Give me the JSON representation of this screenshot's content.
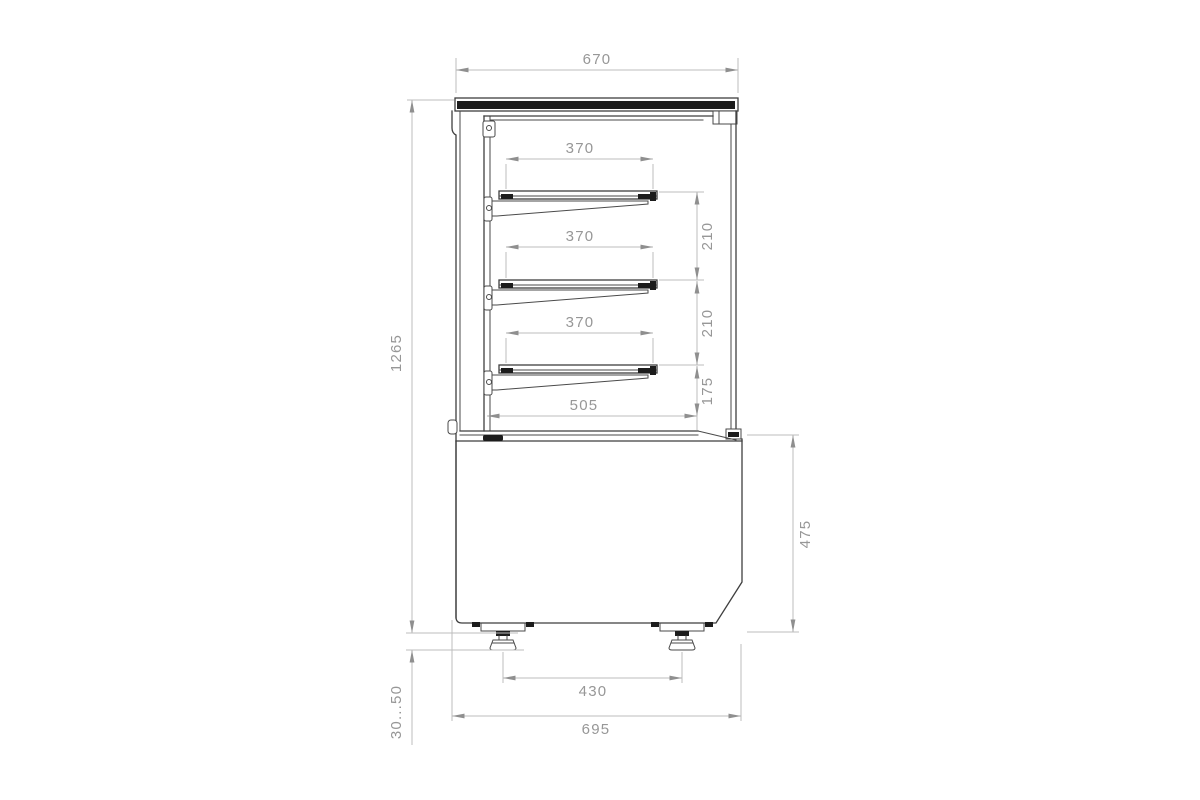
{
  "drawing": {
    "kind": "display-case-side-section-technical-drawing",
    "dimensions": {
      "canopy_width": "670",
      "shelf_widths": [
        "370",
        "370",
        "370"
      ],
      "shelf_spacings": [
        "210",
        "210"
      ],
      "lowest_shelf_clearance": "175",
      "counter_depth": "505",
      "overall_height": "1265",
      "base_height": "475",
      "feet_centers": "430",
      "base_depth": "695",
      "foot_height_range": "30...50"
    },
    "colors": {
      "background": "#ffffff",
      "object_line": "#3f3f3f",
      "dark_fill": "#1c1c1c",
      "dimension_line": "#bcbcbc",
      "dimension_text": "#979797"
    }
  }
}
